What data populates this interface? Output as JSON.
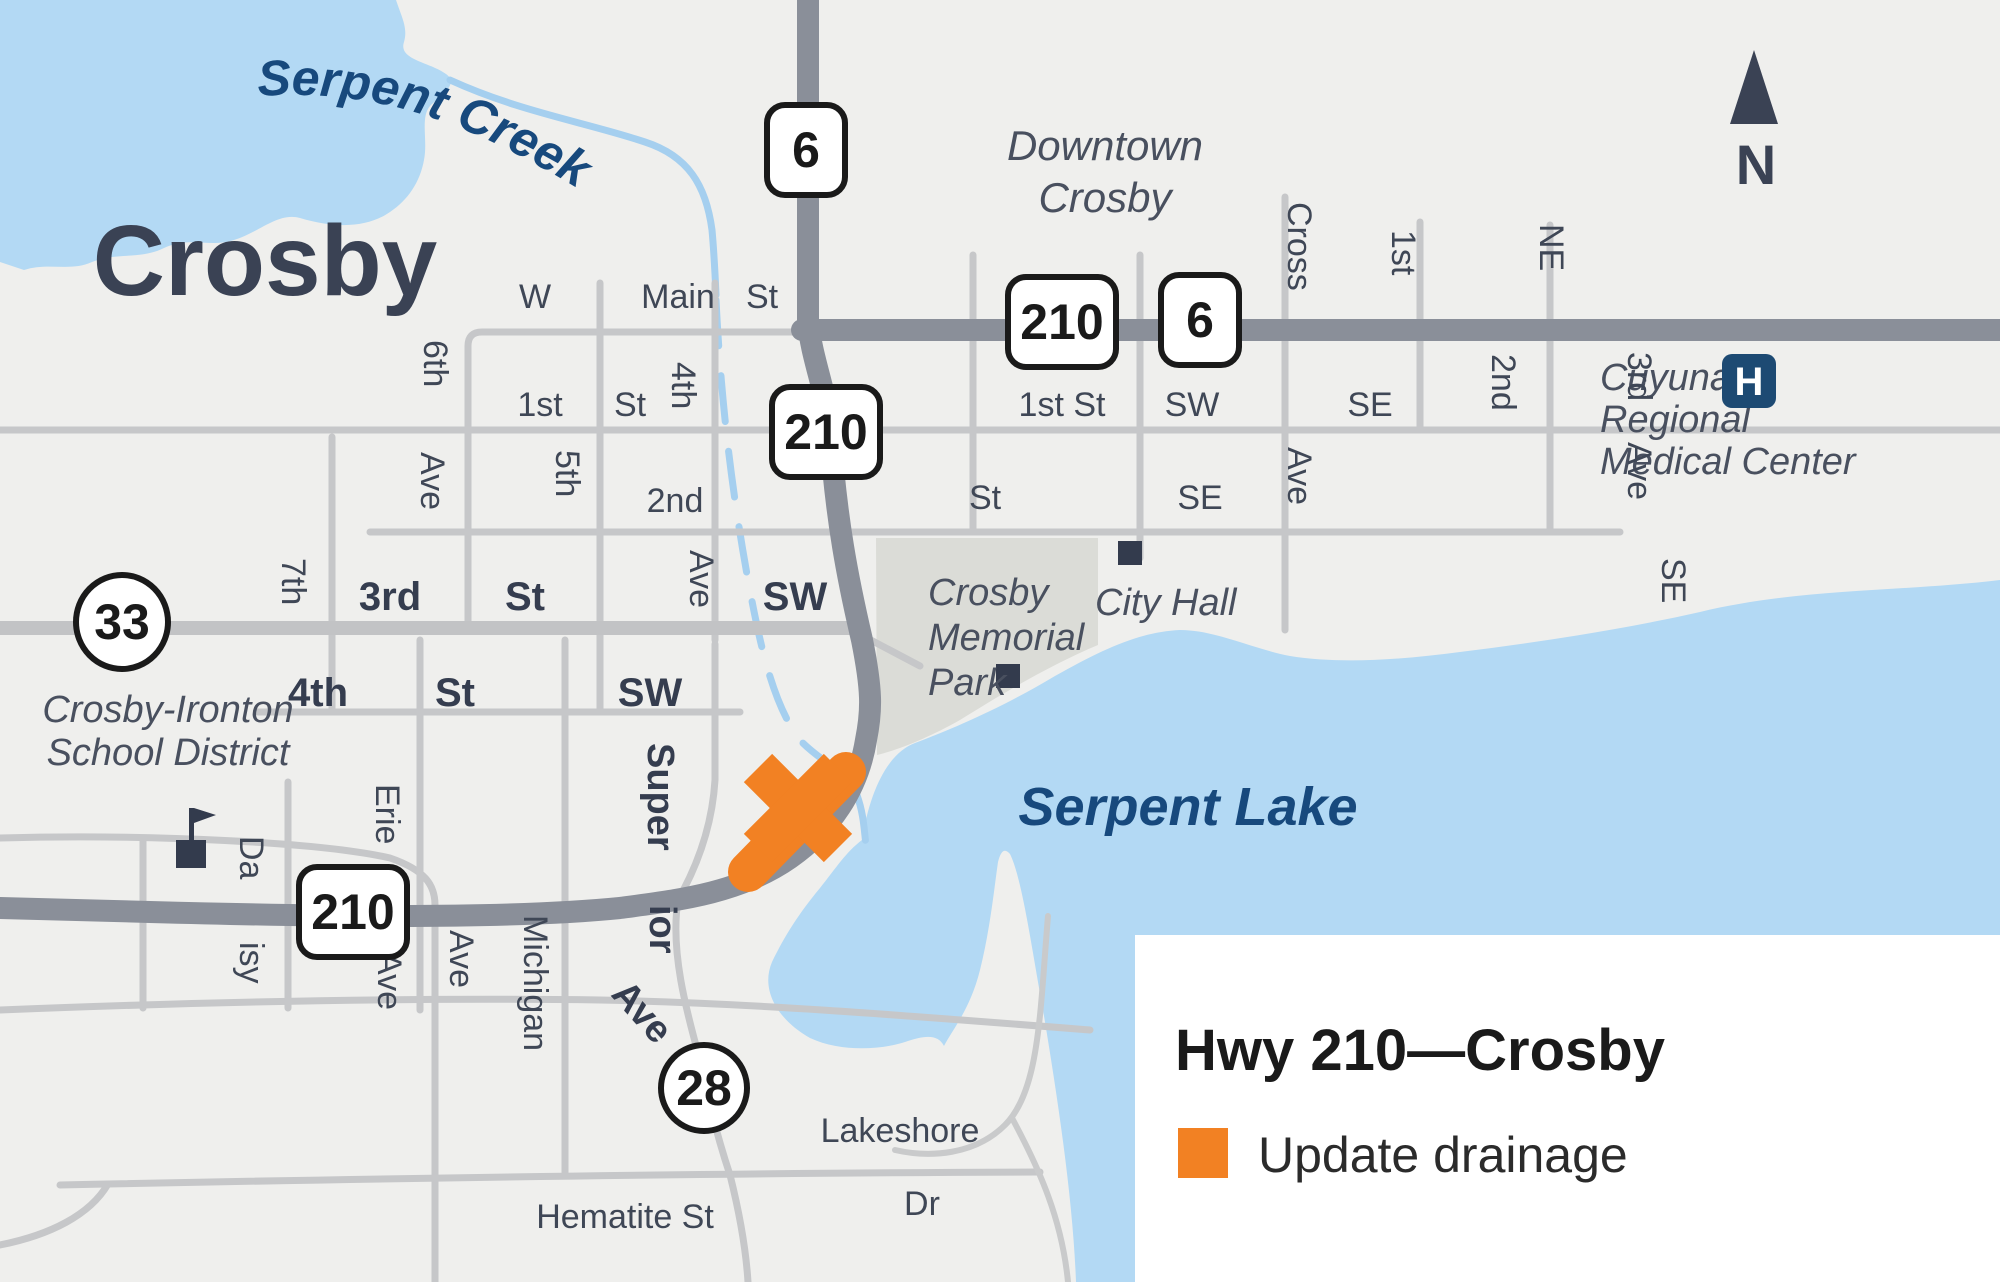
{
  "map": {
    "city": "Crosby",
    "creek": "Serpent Creek",
    "lake": "Serpent Lake",
    "downtown": [
      "Downtown",
      "Crosby"
    ],
    "school": [
      "Crosby-Ironton",
      "School District"
    ],
    "park": [
      "Crosby",
      "Memorial",
      "Park"
    ],
    "city_hall": "City Hall",
    "medical": [
      "Cuyuna",
      "Regional",
      "Medical Center"
    ],
    "hospital_icon_letter": "H",
    "north_letter": "N",
    "shields": {
      "s6": "6",
      "s210": "210",
      "s33": "33",
      "s28": "28"
    },
    "st": {
      "w": "W",
      "main": "Main",
      "main_st": "St",
      "first": "1st",
      "first_st": "St",
      "second": "2nd",
      "third": "3rd",
      "third_st": "St",
      "third_sw": "SW",
      "fourth": "4th",
      "fourth_st": "St",
      "fourth_sw": "SW",
      "a7": "7th",
      "a6": "6th",
      "a6_ave": "Ave",
      "a5": "5th",
      "a4": "4th",
      "a4_ave": "Ave",
      "erie": "Erie",
      "erie_ave": "Ave",
      "michigan": "Michigan",
      "michigan_ave": "Ave",
      "sup1": "Super",
      "sup2": "ior",
      "sup3": "Ave",
      "da": "Da",
      "isy": "isy",
      "hematite": "Hematite St",
      "lakeshore": "Lakeshore",
      "lakeshore_dr": "Dr",
      "e1": "1st St",
      "e1_sw": "SW",
      "e1_se": "SE",
      "e2_st": "St",
      "e2_se": "SE",
      "cross": "Cross",
      "cross_ave": "Ave",
      "ne1": "1st",
      "ne": "NE",
      "se2": "2nd",
      "se3": "3rd",
      "se3_ave": "Ave",
      "se_v": "SE"
    }
  },
  "legend": {
    "title": "Hwy 210—Crosby",
    "items": [
      {
        "label": "Update drainage",
        "color": "#F28123"
      }
    ]
  },
  "colors": {
    "accent_orange": "#F28123",
    "water": "#B3D9F4",
    "creek": "#A5CFEF",
    "land": "#EFEFED",
    "park": "#DBDCD7",
    "road_major": "#8A8F99",
    "road_minor": "#C6C7C9",
    "navy_text": "#3A4254",
    "water_text": "#17497D",
    "hospital_navy": "#1D4A73"
  }
}
